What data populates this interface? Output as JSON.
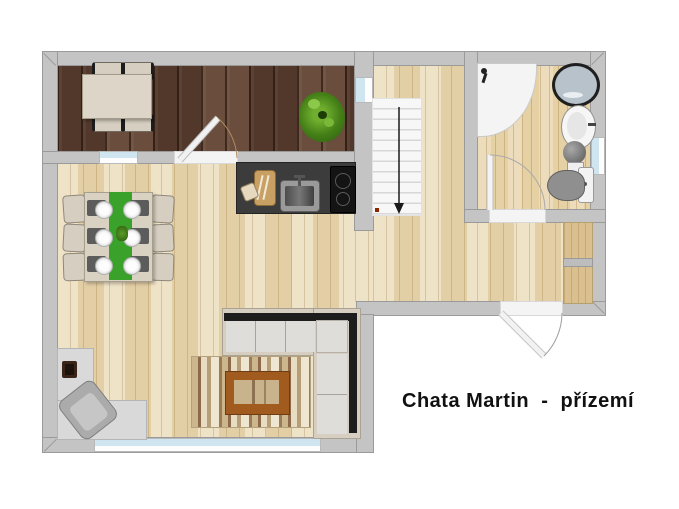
{
  "title": "Chata Martin  -  přízemí",
  "colors": {
    "wall": "#c4c4c4",
    "wallEdge": "#9a9a9a",
    "terraceWood": "#5d4030",
    "floor": "#e9d8b2",
    "bathroomFloor": "#e6d1a4",
    "counter": "#3c3c3c",
    "cooktop": "#141414",
    "windowGlass": "#cfe5f0",
    "stairTread": "#f7f7f7",
    "runnerGreen": "#3aa12b",
    "sofaCushion": "#deddd9",
    "sofaFrame": "#d5cec1",
    "sofaBack": "#1d1d1d",
    "rugBase": "#d3c19c",
    "coffeeFrame": "#a25b1e",
    "coffeeTop": "#c8b38c",
    "deskGray": "#d9d9d9",
    "chairBeige": "#d6cfc1",
    "plantGreen": "#3f7d1c",
    "fixtureWhite": "#f4f4f4",
    "washerBlue": "#b7c2ca",
    "toiletGray": "#8f8f8f",
    "textColor": "#111111"
  },
  "fixtures": [
    "terrace-dining-set",
    "potted-plant",
    "kitchen-counter",
    "kitchen-sink",
    "cooktop",
    "cutting-board",
    "dining-table-for-six",
    "staircase-down",
    "shower",
    "washing-machine",
    "washbasin",
    "water-heater",
    "toilet",
    "entry-cabinet",
    "corner-sofa",
    "rug",
    "coffee-table",
    "desk",
    "desk-chair",
    "laptop"
  ]
}
